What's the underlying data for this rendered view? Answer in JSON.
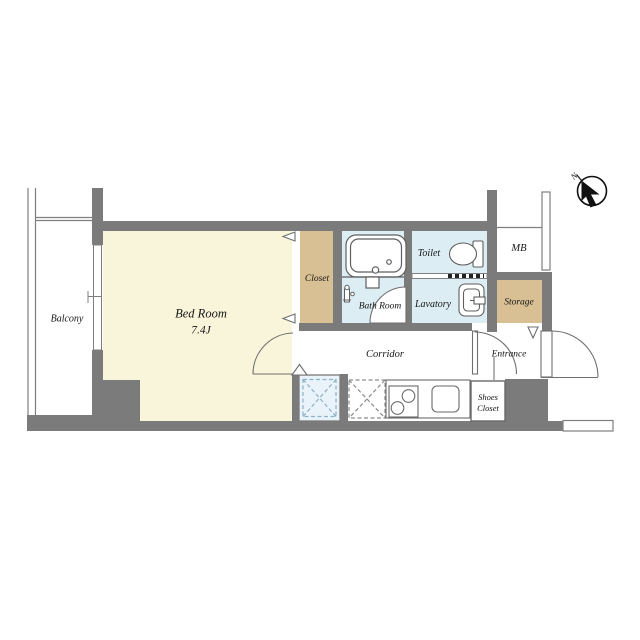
{
  "plan_title": "1K apartment floor plan",
  "compass": {
    "label": "N"
  },
  "rooms": {
    "balcony": "Balcony",
    "bedroom": "Bed Room",
    "bedroom_size": "7.4J",
    "closet": "Closet",
    "bathroom": "Bath Room",
    "toilet": "Toilet",
    "lavatory": "Lavatory",
    "meter_box": "MB",
    "storage": "Storage",
    "corridor": "Corridor",
    "entrance": "Entrance",
    "shoes_closet_line1": "Shoes",
    "shoes_closet_line2": "Closet"
  },
  "colors": {
    "wall": "#7b7b7b",
    "bedroom_floor": "#f9f5da",
    "closet_floor": "#d8bf94",
    "storage_floor": "#d8bf94",
    "wet_area_floor": "#dcedf4",
    "washer_area": "#e9f3f9",
    "washer_dash": "#8ab2c9",
    "outline": "#777777"
  }
}
